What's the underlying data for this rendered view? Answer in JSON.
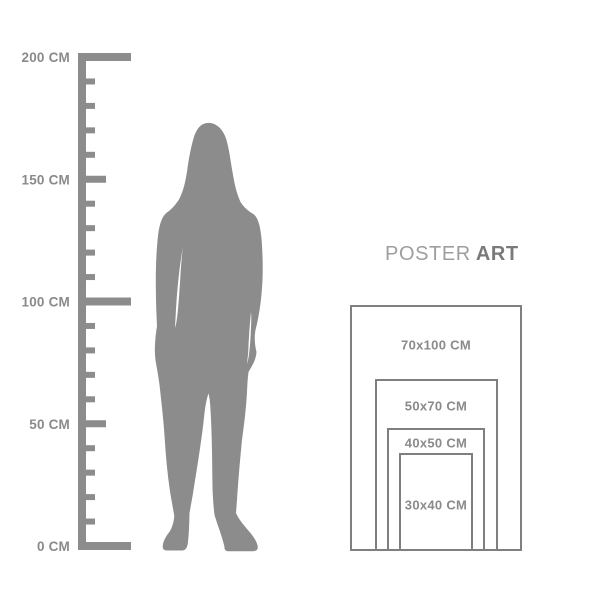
{
  "page": {
    "background_color": "#ffffff",
    "figure_color": "#8c8c8c",
    "description_icon": "size-guide"
  },
  "brand": {
    "regular": "POSTER",
    "bold": "ART",
    "regular_color": "#9e9e9e",
    "bold_color": "#7a7a7a"
  },
  "ruler": {
    "color": "#8c8c8c",
    "label_color": "#8a8a8a",
    "max_cm": 200,
    "minor_tick_interval_cm": 10,
    "unit_labels": [
      {
        "cm": 200,
        "label": "200 CM"
      },
      {
        "cm": 150,
        "label": "150 CM"
      },
      {
        "cm": 100,
        "label": "100 CM"
      },
      {
        "cm": 50,
        "label": "50 CM"
      },
      {
        "cm": 0,
        "label": "0 CM"
      }
    ]
  },
  "size_chart": {
    "border_color": "#7f7f7f",
    "label_color": "#8a8a8a",
    "sizes": [
      {
        "label": "70x100 CM",
        "width_cm": 70,
        "height_cm": 100
      },
      {
        "label": "50x70 CM",
        "width_cm": 50,
        "height_cm": 70
      },
      {
        "label": "40x50 CM",
        "width_cm": 40,
        "height_cm": 50
      },
      {
        "label": "30x40 CM",
        "width_cm": 30,
        "height_cm": 40
      }
    ]
  }
}
